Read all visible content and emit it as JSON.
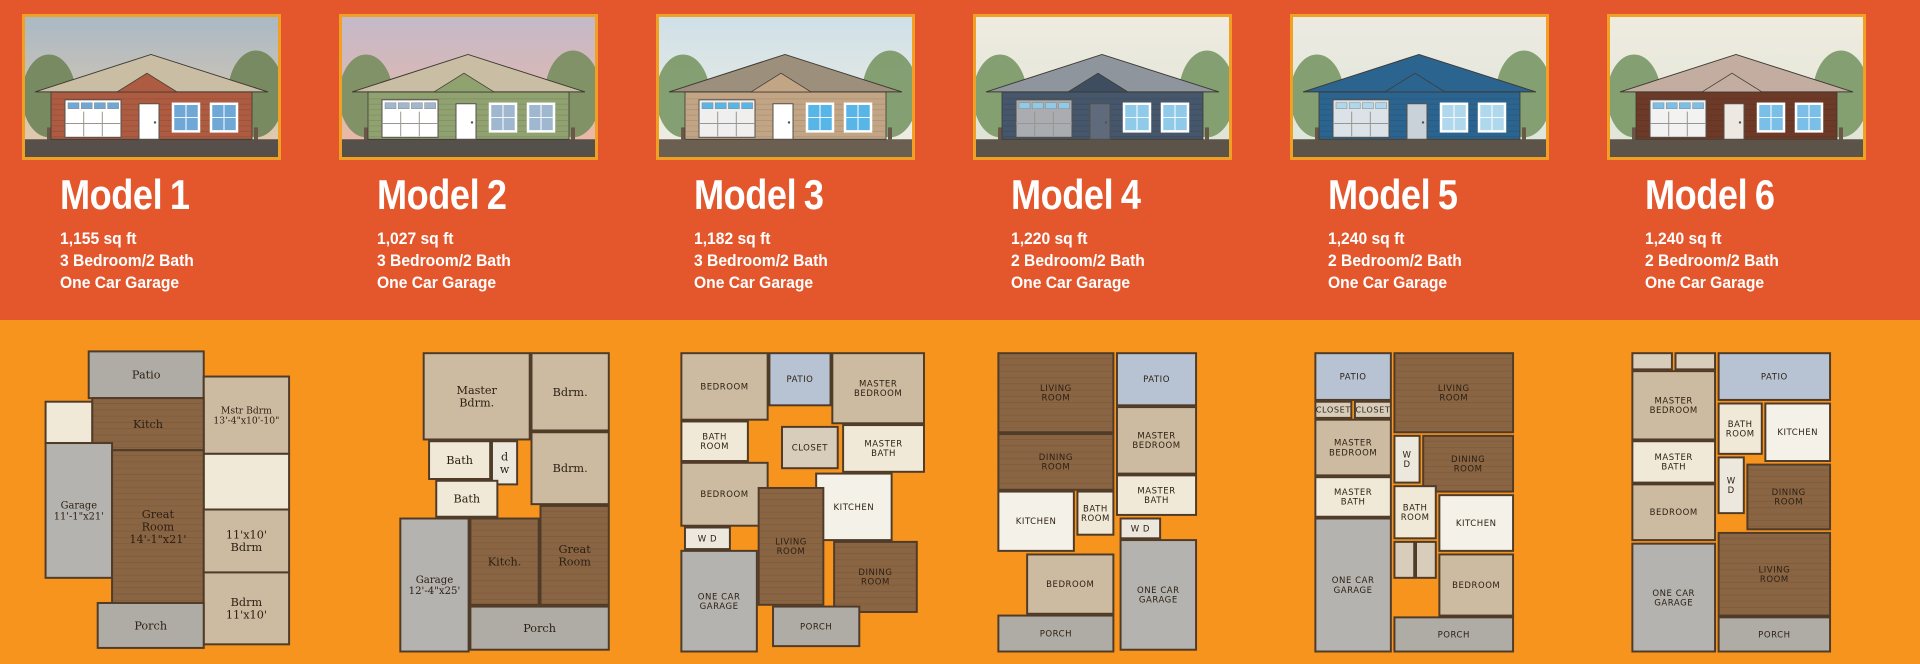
{
  "page": {
    "bg_top": "#E4572C",
    "bg_bottom": "#F7941E",
    "frame_color": "#F2A024",
    "text_color": "#FFFFFF"
  },
  "plan_colors": {
    "wood": "#8A6544",
    "carpet": "#CDBBA1",
    "garage": "#B5B3AF",
    "porch": "#AFACA5",
    "patio": "#B7C3D3",
    "bath": "#F0E9D8",
    "kitchen": "#F4F1E9",
    "closet": "#D8CDBA",
    "util": "#EDE8DE",
    "wall": "#4F3B28",
    "label": "#2B1F12"
  },
  "models": [
    {
      "name_word": "Model",
      "name_number": "1",
      "sqft": "1,155 sq ft",
      "bedbath": "3 Bedroom/2 Bath",
      "garage": "One Car Garage",
      "elevation": {
        "alt": "red-siding-cottage-elevation",
        "sky_top": "#A9B9C5",
        "sky_bottom": "#E9CBA9",
        "tree": "#73875C",
        "ground": "#57504A",
        "roof": "#C9BEA4",
        "body": "#AD5B41",
        "accent": "#AD5B41",
        "garage_door": "#FFFFFF",
        "door": "#FFFFFF",
        "window": "#6FA8D6"
      },
      "floorplan": {
        "label_style": "serif",
        "rooms": [
          {
            "label": "Patio",
            "type": "porch",
            "x": 62,
            "y": 6,
            "w": 128,
            "h": 52
          },
          {
            "label": "Mstr Bdrm\n13'-4\"x10'-10\"",
            "type": "carpet",
            "x": 190,
            "y": 34,
            "w": 95,
            "h": 86
          },
          {
            "label": "",
            "type": "bath",
            "x": 14,
            "y": 62,
            "w": 52,
            "h": 46
          },
          {
            "label": "Kitch",
            "type": "wood",
            "x": 66,
            "y": 58,
            "w": 124,
            "h": 58
          },
          {
            "label": "Garage\n11'-1\"x21'",
            "type": "garage",
            "x": 14,
            "y": 108,
            "w": 74,
            "h": 150
          },
          {
            "label": "",
            "type": "bath",
            "x": 190,
            "y": 120,
            "w": 95,
            "h": 62
          },
          {
            "label": "Great\nRoom\n14'-1\"x21'",
            "type": "wood",
            "x": 88,
            "y": 116,
            "w": 102,
            "h": 170
          },
          {
            "label": "11'x10'\nBdrm",
            "type": "carpet",
            "x": 190,
            "y": 182,
            "w": 95,
            "h": 70
          },
          {
            "label": "Bdrm\n11'x10'",
            "type": "carpet",
            "x": 190,
            "y": 252,
            "w": 95,
            "h": 80
          },
          {
            "label": "Porch",
            "type": "porch",
            "x": 72,
            "y": 286,
            "w": 118,
            "h": 50
          }
        ]
      }
    },
    {
      "name_word": "Model",
      "name_number": "2",
      "sqft": "1,027 sq ft",
      "bedbath": "3 Bedroom/2 Bath",
      "garage": "One Car Garage",
      "elevation": {
        "alt": "green-siding-cottage-elevation",
        "sky_top": "#C4B9C9",
        "sky_bottom": "#F0B8A1",
        "tree": "#7C8F63",
        "ground": "#555049",
        "roof": "#C9BEA4",
        "body": "#91A271",
        "accent": "#91A271",
        "garage_door": "#FFFFFF",
        "door": "#FFFFFF",
        "window": "#9FB8CF"
      },
      "floorplan": {
        "label_style": "serif",
        "rooms": [
          {
            "label": "Master\nBdrm.",
            "type": "carpet",
            "x": 82,
            "y": 8,
            "w": 118,
            "h": 96
          },
          {
            "label": "Bdrm.",
            "type": "carpet",
            "x": 202,
            "y": 8,
            "w": 86,
            "h": 86
          },
          {
            "label": "Bath",
            "type": "bath",
            "x": 88,
            "y": 106,
            "w": 68,
            "h": 42
          },
          {
            "label": "d\nw",
            "type": "util",
            "x": 158,
            "y": 106,
            "w": 28,
            "h": 48
          },
          {
            "label": "Bdrm.",
            "type": "carpet",
            "x": 202,
            "y": 96,
            "w": 86,
            "h": 80
          },
          {
            "label": "Bath",
            "type": "bath",
            "x": 96,
            "y": 150,
            "w": 68,
            "h": 40
          },
          {
            "label": "Kitch.",
            "type": "wood",
            "x": 134,
            "y": 192,
            "w": 76,
            "h": 96
          },
          {
            "label": "Great\nRoom",
            "type": "wood",
            "x": 212,
            "y": 178,
            "w": 76,
            "h": 110
          },
          {
            "label": "Garage\n12'-4\"x25'",
            "type": "garage",
            "x": 56,
            "y": 192,
            "w": 76,
            "h": 148
          },
          {
            "label": "Porch",
            "type": "porch",
            "x": 134,
            "y": 290,
            "w": 154,
            "h": 48
          }
        ]
      }
    },
    {
      "name_word": "Model",
      "name_number": "3",
      "sqft": "1,182 sq ft",
      "bedbath": "3 Bedroom/2 Bath",
      "garage": "One Car Garage",
      "elevation": {
        "alt": "tan-siding-house-elevation",
        "sky_top": "#CFE0E8",
        "sky_bottom": "#F2EEE2",
        "tree": "#7E9B6A",
        "ground": "#6B5F52",
        "roof": "#9C8F7C",
        "body": "#C2A585",
        "accent": "#C2A585",
        "garage_door": "#EFEFEF",
        "door": "#FFFFFF",
        "window": "#58B5E8"
      },
      "floorplan": {
        "label_style": "hand",
        "rooms": [
          {
            "label": "BEDROOM",
            "type": "carpet",
            "x": 16,
            "y": 8,
            "w": 96,
            "h": 74
          },
          {
            "label": "PATIO",
            "type": "patio",
            "x": 114,
            "y": 8,
            "w": 68,
            "h": 58
          },
          {
            "label": "MASTER\nBEDROOM",
            "type": "carpet",
            "x": 184,
            "y": 8,
            "w": 102,
            "h": 78
          },
          {
            "label": "BATH\nROOM",
            "type": "bath",
            "x": 16,
            "y": 84,
            "w": 74,
            "h": 44
          },
          {
            "label": "CLOSET",
            "type": "closet",
            "x": 128,
            "y": 90,
            "w": 62,
            "h": 46
          },
          {
            "label": "MASTER\nBATH",
            "type": "bath",
            "x": 196,
            "y": 88,
            "w": 90,
            "h": 52
          },
          {
            "label": "BEDROOM",
            "type": "carpet",
            "x": 16,
            "y": 130,
            "w": 96,
            "h": 70
          },
          {
            "label": "KITCHEN",
            "type": "kitchen",
            "x": 166,
            "y": 142,
            "w": 84,
            "h": 74
          },
          {
            "label": "W  D",
            "type": "util",
            "x": 20,
            "y": 202,
            "w": 50,
            "h": 24
          },
          {
            "label": "LIVING\nROOM",
            "type": "wood",
            "x": 102,
            "y": 158,
            "w": 72,
            "h": 130
          },
          {
            "label": "DINING\nROOM",
            "type": "wood",
            "x": 186,
            "y": 218,
            "w": 92,
            "h": 78
          },
          {
            "label": "ONE CAR\nGARAGE",
            "type": "garage",
            "x": 16,
            "y": 228,
            "w": 84,
            "h": 112
          },
          {
            "label": "PORCH",
            "type": "porch",
            "x": 118,
            "y": 290,
            "w": 96,
            "h": 44
          }
        ]
      }
    },
    {
      "name_word": "Model",
      "name_number": "4",
      "sqft": "1,220 sq ft",
      "bedbath": "2 Bedroom/2 Bath",
      "garage": "One Car Garage",
      "elevation": {
        "alt": "dark-slate-modern-house-elevation",
        "sky_top": "#EFEBE0",
        "sky_bottom": "#DDE3D5",
        "tree": "#7E9B6A",
        "ground": "#5C5349",
        "roof": "#8E959C",
        "body": "#46566B",
        "accent": "#3E4D60",
        "garage_door": "#A9ACB0",
        "door": "#5F6B7C",
        "window": "#8FCBE8"
      },
      "floorplan": {
        "label_style": "hand",
        "rooms": [
          {
            "label": "LIVING\nROOM",
            "type": "wood",
            "x": 16,
            "y": 8,
            "w": 128,
            "h": 88
          },
          {
            "label": "PATIO",
            "type": "patio",
            "x": 148,
            "y": 8,
            "w": 88,
            "h": 58
          },
          {
            "label": "MASTER\nBEDROOM",
            "type": "carpet",
            "x": 148,
            "y": 68,
            "w": 88,
            "h": 74
          },
          {
            "label": "DINING\nROOM",
            "type": "wood",
            "x": 16,
            "y": 98,
            "w": 128,
            "h": 62
          },
          {
            "label": "MASTER\nBATH",
            "type": "bath",
            "x": 148,
            "y": 144,
            "w": 88,
            "h": 44
          },
          {
            "label": "KITCHEN",
            "type": "kitchen",
            "x": 16,
            "y": 162,
            "w": 84,
            "h": 66
          },
          {
            "label": "BATH\nROOM",
            "type": "bath",
            "x": 104,
            "y": 162,
            "w": 40,
            "h": 48
          },
          {
            "label": "W D",
            "type": "util",
            "x": 152,
            "y": 192,
            "w": 44,
            "h": 22
          },
          {
            "label": "BEDROOM",
            "type": "carpet",
            "x": 48,
            "y": 232,
            "w": 96,
            "h": 66
          },
          {
            "label": "ONE CAR\nGARAGE",
            "type": "garage",
            "x": 152,
            "y": 216,
            "w": 84,
            "h": 122
          },
          {
            "label": "PORCH",
            "type": "porch",
            "x": 16,
            "y": 300,
            "w": 128,
            "h": 40
          }
        ]
      }
    },
    {
      "name_word": "Model",
      "name_number": "5",
      "sqft": "1,240 sq ft",
      "bedbath": "2 Bedroom/2 Bath",
      "garage": "One Car Garage",
      "elevation": {
        "alt": "blue-board-and-batten-house-elevation",
        "sky_top": "#EDEAE0",
        "sky_bottom": "#DCE5DC",
        "tree": "#7E9B6A",
        "ground": "#5C5349",
        "roof": "#2C6490",
        "body": "#2C6490",
        "accent": "#2C6490",
        "garage_door": "#DCE3E8",
        "door": "#C9D2D8",
        "window": "#AFD8EC"
      },
      "floorplan": {
        "label_style": "hand",
        "rooms": [
          {
            "label": "PATIO",
            "type": "patio",
            "x": 16,
            "y": 8,
            "w": 84,
            "h": 52
          },
          {
            "label": "LIVING\nROOM",
            "type": "wood",
            "x": 104,
            "y": 8,
            "w": 132,
            "h": 88
          },
          {
            "label": "CLOSET",
            "type": "closet",
            "x": 16,
            "y": 62,
            "w": 40,
            "h": 18
          },
          {
            "label": "CLOSET",
            "type": "closet",
            "x": 60,
            "y": 62,
            "w": 40,
            "h": 18
          },
          {
            "label": "MASTER\nBEDROOM",
            "type": "carpet",
            "x": 16,
            "y": 82,
            "w": 84,
            "h": 62
          },
          {
            "label": "W\nD",
            "type": "util",
            "x": 104,
            "y": 100,
            "w": 28,
            "h": 52
          },
          {
            "label": "DINING\nROOM",
            "type": "wood",
            "x": 136,
            "y": 100,
            "w": 100,
            "h": 62
          },
          {
            "label": "MASTER\nBATH",
            "type": "bath",
            "x": 16,
            "y": 146,
            "w": 84,
            "h": 44
          },
          {
            "label": "BATH\nROOM",
            "type": "bath",
            "x": 104,
            "y": 156,
            "w": 46,
            "h": 58
          },
          {
            "label": "KITCHEN",
            "type": "kitchen",
            "x": 154,
            "y": 166,
            "w": 82,
            "h": 62
          },
          {
            "label": "ONE CAR\nGARAGE",
            "type": "garage",
            "x": 16,
            "y": 192,
            "w": 84,
            "h": 148
          },
          {
            "label": "",
            "type": "closet",
            "x": 104,
            "y": 218,
            "w": 22,
            "h": 40
          },
          {
            "label": "",
            "type": "closet",
            "x": 128,
            "y": 218,
            "w": 22,
            "h": 40
          },
          {
            "label": "BEDROOM",
            "type": "carpet",
            "x": 154,
            "y": 232,
            "w": 82,
            "h": 68
          },
          {
            "label": "PORCH",
            "type": "porch",
            "x": 104,
            "y": 302,
            "w": 132,
            "h": 38
          }
        ]
      }
    },
    {
      "name_word": "Model",
      "name_number": "6",
      "sqft": "1,240 sq ft",
      "bedbath": "2 Bedroom/2 Bath",
      "garage": "One Car Garage",
      "elevation": {
        "alt": "red-brick-house-elevation",
        "sky_top": "#EFEBDF",
        "sky_bottom": "#DFE5D8",
        "tree": "#7E9B6A",
        "ground": "#5C5349",
        "roof": "#C3ACA0",
        "body": "#6E3A28",
        "accent": "#C3ACA0",
        "garage_door": "#F2F2F2",
        "door": "#EDE8E2",
        "window": "#79BFE8"
      },
      "floorplan": {
        "label_style": "hand",
        "rooms": [
          {
            "label": "",
            "type": "closet",
            "x": 16,
            "y": 8,
            "w": 44,
            "h": 18
          },
          {
            "label": "",
            "type": "closet",
            "x": 64,
            "y": 8,
            "w": 44,
            "h": 18
          },
          {
            "label": "MASTER\nBEDROOM",
            "type": "carpet",
            "x": 16,
            "y": 28,
            "w": 92,
            "h": 76
          },
          {
            "label": "PATIO",
            "type": "patio",
            "x": 112,
            "y": 8,
            "w": 124,
            "h": 52
          },
          {
            "label": "BATH\nROOM",
            "type": "bath",
            "x": 112,
            "y": 64,
            "w": 48,
            "h": 56
          },
          {
            "label": "KITCHEN",
            "type": "kitchen",
            "x": 164,
            "y": 64,
            "w": 72,
            "h": 64
          },
          {
            "label": "MASTER\nBATH",
            "type": "bath",
            "x": 16,
            "y": 106,
            "w": 92,
            "h": 46
          },
          {
            "label": "BEDROOM",
            "type": "carpet",
            "x": 16,
            "y": 154,
            "w": 92,
            "h": 62
          },
          {
            "label": "W\nD",
            "type": "util",
            "x": 112,
            "y": 124,
            "w": 28,
            "h": 62
          },
          {
            "label": "DINING\nROOM",
            "type": "wood",
            "x": 144,
            "y": 132,
            "w": 92,
            "h": 72
          },
          {
            "label": "ONE CAR\nGARAGE",
            "type": "garage",
            "x": 16,
            "y": 220,
            "w": 92,
            "h": 120
          },
          {
            "label": "LIVING\nROOM",
            "type": "wood",
            "x": 112,
            "y": 208,
            "w": 124,
            "h": 92
          },
          {
            "label": "PORCH",
            "type": "porch",
            "x": 112,
            "y": 302,
            "w": 124,
            "h": 38
          }
        ]
      }
    }
  ]
}
